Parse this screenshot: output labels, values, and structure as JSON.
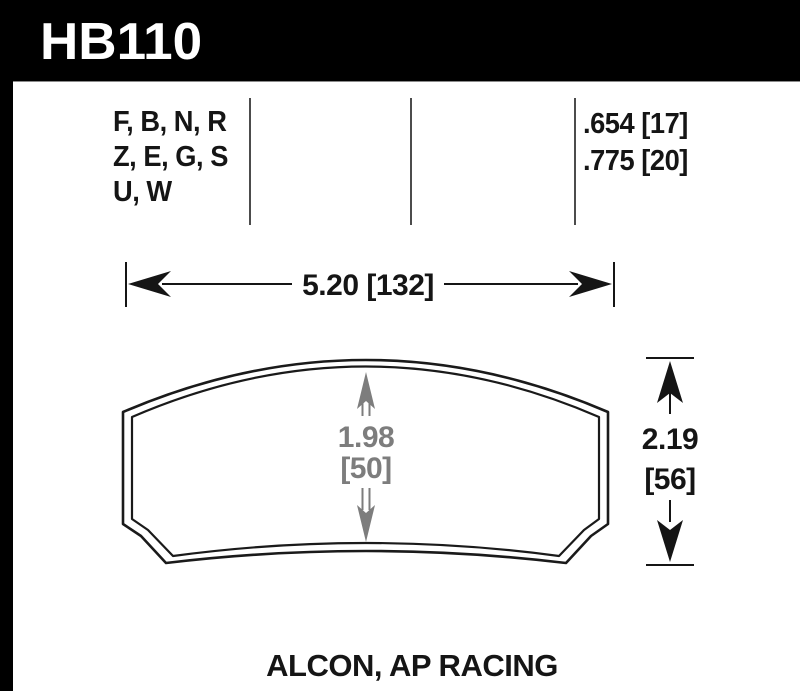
{
  "header": {
    "part_number": "HB110"
  },
  "spec_table": {
    "compound_lines": [
      "F, B, N, R",
      "Z, E, G, S",
      "U, W"
    ],
    "thickness_lines": [
      ".654 [17]",
      ".775 [20]"
    ]
  },
  "drawing": {
    "width_dim": "5.20 [132]",
    "height_dim_in": "2.19",
    "height_dim_mm": "[56]",
    "center_dim_in": "1.98",
    "center_dim_mm": "[50]"
  },
  "footer": {
    "applications": "ALCON, AP RACING"
  },
  "colors": {
    "background": "#ffffff",
    "header_bar": "#000000",
    "text_primary": "#151515",
    "dimension_gray": "#7d7d7d",
    "divider_gray": "#4c4c4c"
  },
  "icons": {
    "dimension_arrowhead": "barbed-triangle",
    "extension_line": "tick"
  }
}
